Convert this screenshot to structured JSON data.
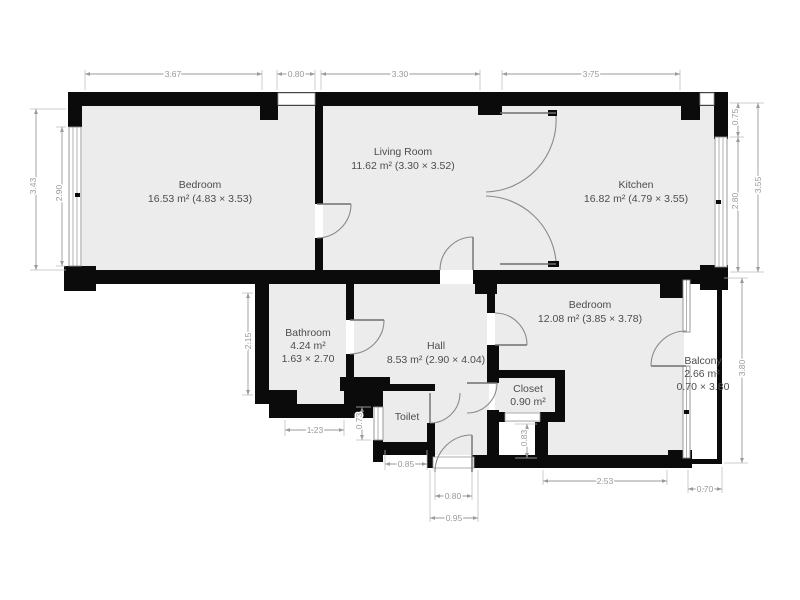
{
  "plan": {
    "rooms": {
      "bedroom1": {
        "name": "Bedroom",
        "area": "16.53 m² (4.83 × 3.53)"
      },
      "living": {
        "name": "Living Room",
        "area": "11.62 m² (3.30 × 3.52)"
      },
      "kitchen": {
        "name": "Kitchen",
        "area": "16.82 m² (4.79 × 3.55)"
      },
      "bathroom": {
        "name": "Bathroom",
        "area": "4.24 m²",
        "dims": "1.63 × 2.70"
      },
      "hall": {
        "name": "Hall",
        "area": "8.53 m² (2.90 × 4.04)"
      },
      "toilet": {
        "name": "Toilet"
      },
      "closet": {
        "name": "Closet",
        "area": "0.90 m²"
      },
      "bedroom2": {
        "name": "Bedroom",
        "area": "12.08 m² (3.85 × 3.78)"
      },
      "balcony": {
        "name": "Balcony",
        "area": "2.66 m²",
        "dims": "0.70 × 3.80"
      }
    },
    "dimensions": {
      "top_1": "3.67",
      "top_2": "0.80",
      "top_3": "3.30",
      "top_4": "3.75",
      "left_outer": "3.43",
      "left_window": "2.90",
      "right_top": "0.75",
      "right_window": "2.80",
      "right_outer": "3.55",
      "right_balcony": "3.80",
      "bath_left": "2.15",
      "bath_bottom": "1.23",
      "toilet_window": "0.73",
      "toilet_bottom": "0.85",
      "entry_inner": "0.80",
      "entry_outer": "0.95",
      "closet_passage": "0.83",
      "bed2_bottom": "2.53",
      "balcony_bottom": "0.70"
    },
    "colors": {
      "wall": "#0b0b0b",
      "room_fill": "#ececec",
      "dimension": "#9a9a9a",
      "label_text": "#4d4d4d"
    }
  }
}
